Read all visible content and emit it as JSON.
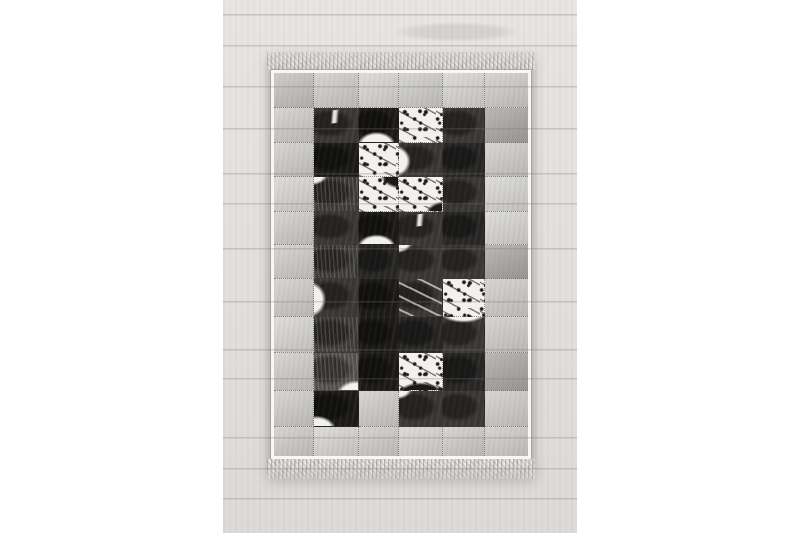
{
  "meta": {
    "canvas_width": 800,
    "canvas_height": 533,
    "subject": "patchwork hide rug in black, white and grey with fringed ends, lying on whitewashed wood plank floor, product photo on white background"
  },
  "palette": {
    "page_bg": "#ffffff",
    "wood_base": "#e3e1de",
    "binding": "#f8f7f5",
    "fringe_light": "#dbdad7",
    "fringe_dark": "#b3b2af",
    "stitch": "rgba(60,57,54,0.5)",
    "l1": "#c8c7c4",
    "l2": "#d2d1ce",
    "l3": "#bcbbb8",
    "m": "#9f9e9b",
    "d": "#393735",
    "dk": "#272625",
    "k": "#1b1a19",
    "dm": "#4f4c49",
    "w": "#f2f1ee"
  },
  "photo": {
    "left": 223,
    "top": 0,
    "width": 354,
    "height": 533,
    "plank_seams_y": [
      14,
      45,
      86,
      128,
      173,
      203,
      248,
      301,
      349,
      378,
      437,
      468,
      498
    ]
  },
  "rug": {
    "left": 44,
    "top": 52,
    "width": 268,
    "fringe_top_height": 18,
    "fringe_bottom_height": 20,
    "grid": {
      "cols": 6,
      "rows": 11,
      "col_widths_px": [
        40,
        44,
        40,
        44,
        41,
        43
      ],
      "row_heights_px": [
        35,
        35,
        34,
        35,
        33,
        34,
        38,
        36,
        38,
        36,
        29
      ],
      "cells": [
        [
          "l3",
          "l1",
          "l2",
          "l1",
          "l2",
          "l1"
        ],
        [
          "l1",
          "d|streak",
          "k|wb",
          "w",
          "d",
          "m"
        ],
        [
          "l1",
          "k",
          "w",
          "d|wl",
          "dk",
          "l1"
        ],
        [
          "l2",
          "d|fur|wtl",
          "w|dtr",
          "w|dbr",
          "d",
          "l2"
        ],
        [
          "l1",
          "d",
          "k|wb",
          "d|streak",
          "dk",
          "l2"
        ],
        [
          "l1",
          "d|fur",
          "dk",
          "d|wtl",
          "d",
          "m"
        ],
        [
          "l1",
          "d|wl",
          "k",
          "d|marble",
          "w",
          "l1"
        ],
        [
          "l2",
          "d|fur",
          "k",
          "dk",
          "d|wt",
          "l1"
        ],
        [
          "l1",
          "dm|fur|wbr",
          "k",
          "w|db",
          "dk",
          "m"
        ],
        [
          "l1",
          "k|wbl",
          "l1",
          "d|wtl",
          "d",
          "l1"
        ],
        [
          "l1",
          "l2",
          "l1",
          "l2",
          "l1",
          "l1"
        ]
      ],
      "cell_legend": {
        "l1": "light grey hide",
        "l2": "pale grey hide",
        "l3": "grey hide",
        "m": "mid grey hide",
        "d": "dark charcoal hide",
        "dk": "deep charcoal hide",
        "k": "black hide",
        "dm": "dark brindle hide",
        "w": "white speckled hide",
        "wb": "white patch bottom",
        "wbl": "white patch bottom-left",
        "wbr": "white patch bottom-right",
        "wtl": "white patch top-left",
        "wt": "white patch top",
        "wl": "white patch left",
        "db": "dark patch bottom",
        "dbr": "dark patch bottom-right",
        "dtr": "dark patch top-right",
        "streak": "thin white diagonal streak",
        "marble": "white marbling",
        "fur": "brindle fur streaks"
      }
    }
  }
}
